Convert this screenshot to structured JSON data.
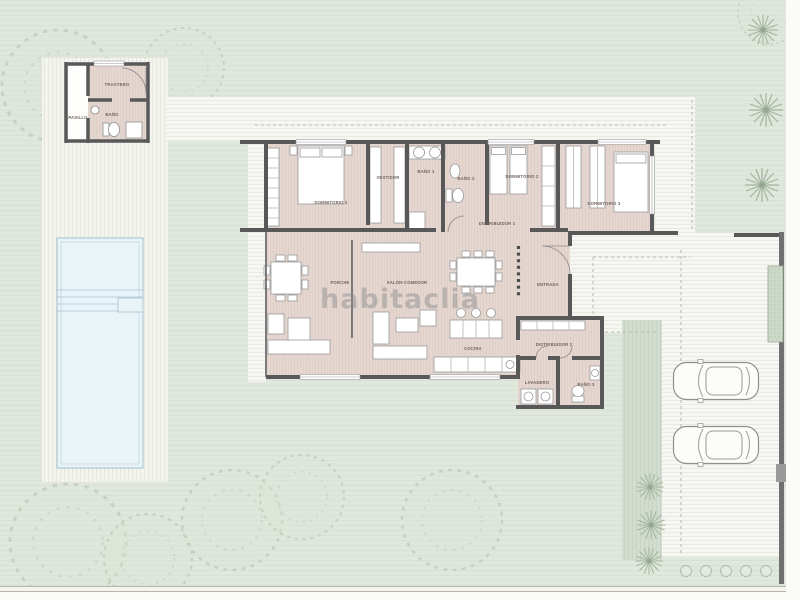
{
  "title": "Villa floor plan with pool and parking",
  "watermark": {
    "text": "habitaclia"
  },
  "rooms": [
    {
      "id": "trastero",
      "label": "TRASTERO"
    },
    {
      "id": "pasillo",
      "label": "PASILLO"
    },
    {
      "id": "bano-anexo",
      "label": "BAÑO"
    },
    {
      "id": "dormitorio-1",
      "label": "DORMITORIO 1"
    },
    {
      "id": "vestidor",
      "label": "VESTIDOR"
    },
    {
      "id": "bano-1",
      "label": "BAÑO 1"
    },
    {
      "id": "bano-2",
      "label": "BAÑO 2"
    },
    {
      "id": "dormitorio-2",
      "label": "DORMITORIO 2"
    },
    {
      "id": "dormitorio-3",
      "label": "DORMITORIO 3"
    },
    {
      "id": "distribuidor-1",
      "label": "DISTRIBUIDOR 1"
    },
    {
      "id": "porche",
      "label": "PORCHE"
    },
    {
      "id": "salon-comedor",
      "label": "SALÓN-COMEDOR"
    },
    {
      "id": "entrada",
      "label": "ENTRADA"
    },
    {
      "id": "cocina",
      "label": "COCINA"
    },
    {
      "id": "distribuidor-2",
      "label": "DISTRIBUIDOR 2"
    },
    {
      "id": "lavadero",
      "label": "LAVADERO"
    },
    {
      "id": "bano-3",
      "label": "BAÑO 3"
    }
  ],
  "site": {
    "pool": true,
    "cars": 2,
    "palm_trees": 6,
    "bushes": 5,
    "garden_trees": 8
  },
  "colors": {
    "lawn": "#e0e7dd",
    "paving": "#f6f6f2",
    "deck": "#f4f4ef",
    "interior_floor": "#e5d7d0",
    "walls": "#585858",
    "pool_water": "#e9f4f9",
    "watermark": "#8d8d8d"
  }
}
